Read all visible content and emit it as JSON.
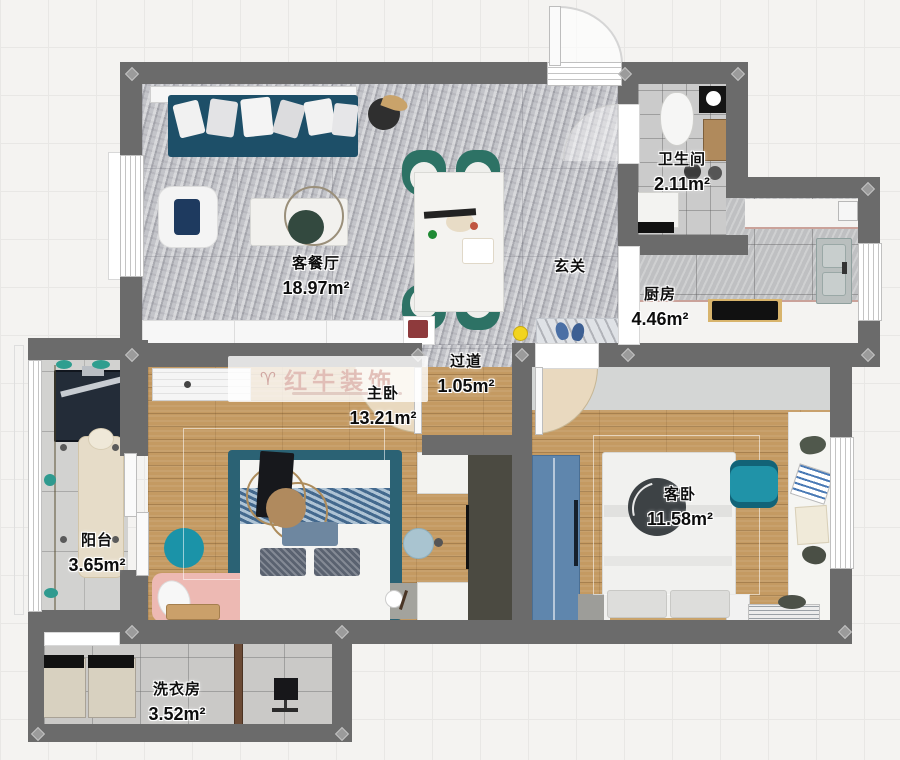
{
  "floorplan": {
    "watermark": {
      "brand": "红牛装饰",
      "logo_icon": "bull-logo-icon"
    },
    "rooms": {
      "living": {
        "name": "客餐厅",
        "area": "18.97m²"
      },
      "hall": {
        "name": "玄关"
      },
      "bath": {
        "name": "卫生间",
        "area": "2.11m²"
      },
      "kitchen": {
        "name": "厨房",
        "area": "4.46m²"
      },
      "corridor": {
        "name": "过道",
        "area": "1.05m²"
      },
      "master": {
        "name": "主卧",
        "area": "13.21m²"
      },
      "guest": {
        "name": "客卧",
        "area": "11.58m²"
      },
      "balcony": {
        "name": "阳台",
        "area": "3.65m²"
      },
      "laundry": {
        "name": "洗衣房",
        "area": "3.52m²"
      }
    },
    "colors": {
      "wall": "#6b6b6b",
      "wood_floor": "#c49a62",
      "marble_floor": "#b9bac0",
      "sofa_teal": "#1d4f68",
      "chair_green": "#2d7265",
      "wardrobe_blue": "#5f86ad",
      "office_chair_teal": "#2093a8",
      "rug_pink": "#edb9b3",
      "rug_teal": "#1b93a8",
      "dot_yellow": "#f2d41f"
    }
  }
}
